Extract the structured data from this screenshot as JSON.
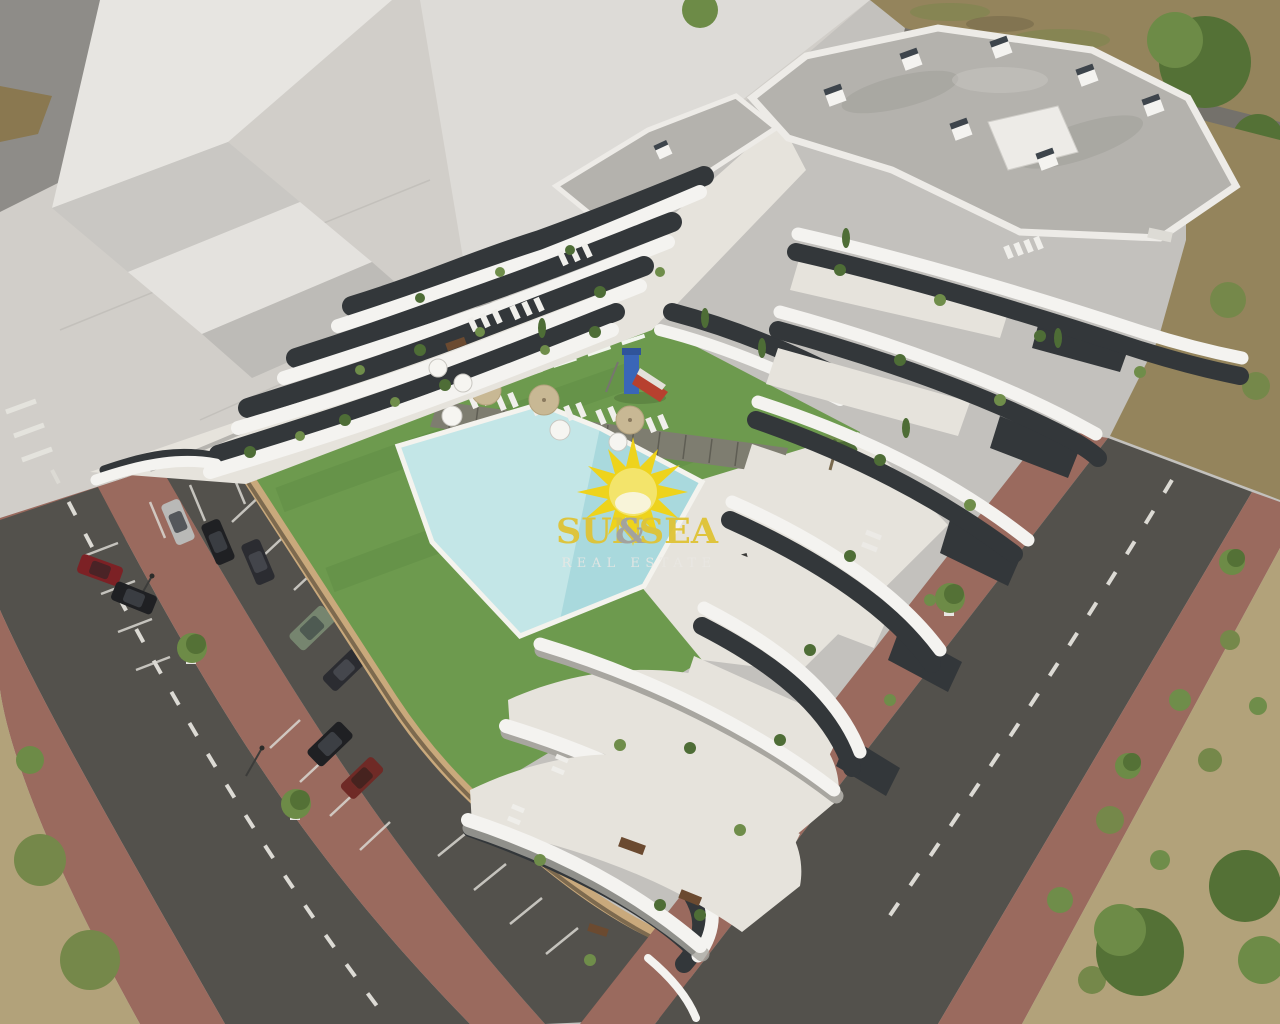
{
  "scene": {
    "type": "architectural_render",
    "description": "Aerial 3D rendering of a white terraced apartment complex with communal pool, lawn, playground, parking lot and surrounding streets",
    "watermark": {
      "word1": "SUN",
      "amp": "&",
      "word2": "SEA",
      "tagline": "REAL ESTATE"
    },
    "palette": {
      "plaza": "#d1cec9",
      "plaza_light": "#e8e6e2",
      "plaza_mid": "#c3c1bd",
      "plaza_dark": "#8e8c88",
      "brick": "#99695d",
      "asphalt": "#53514c",
      "asphalt_light": "#74716b",
      "dash": "#dcdad4",
      "paver": "#9a6a5e",
      "dirt": "#94845c",
      "scrub": "#b2a27a",
      "scrub_green": "#75884a",
      "tree": "#547136",
      "tree_light": "#6d8b47",
      "lawn": "#6d9a4e",
      "lawn_dark": "#578540",
      "pool": "#c3e6e7",
      "pool_deep": "#8fccd4",
      "deck": "#7e7d70",
      "wall_tan": "#c9a97c",
      "wall_dark": "#6a5a44",
      "white": "#f4f3f0",
      "floor": "#e6e3dc",
      "shadow": "#a8a6a0",
      "win": "#33373a",
      "glass": "#596165",
      "roof": "#b4b2ad",
      "roof_dark": "#96948f",
      "parapet": "#edebe7",
      "plant": "#4e6d36",
      "plant_light": "#6f8d4a",
      "car_silver": "#b9b9b7",
      "car_black": "#1f2023",
      "car_red": "#7c2125",
      "car_green": "#76856f",
      "car_darkred": "#6f2a26",
      "car_dark": "#2b2c31",
      "sun": "#f2d312",
      "sun_core": "#f8e565",
      "sun_pale": "#fdf6d9",
      "logo": "#dfc335",
      "amp": "#a3a19b",
      "sub": "#eae8e4"
    }
  }
}
